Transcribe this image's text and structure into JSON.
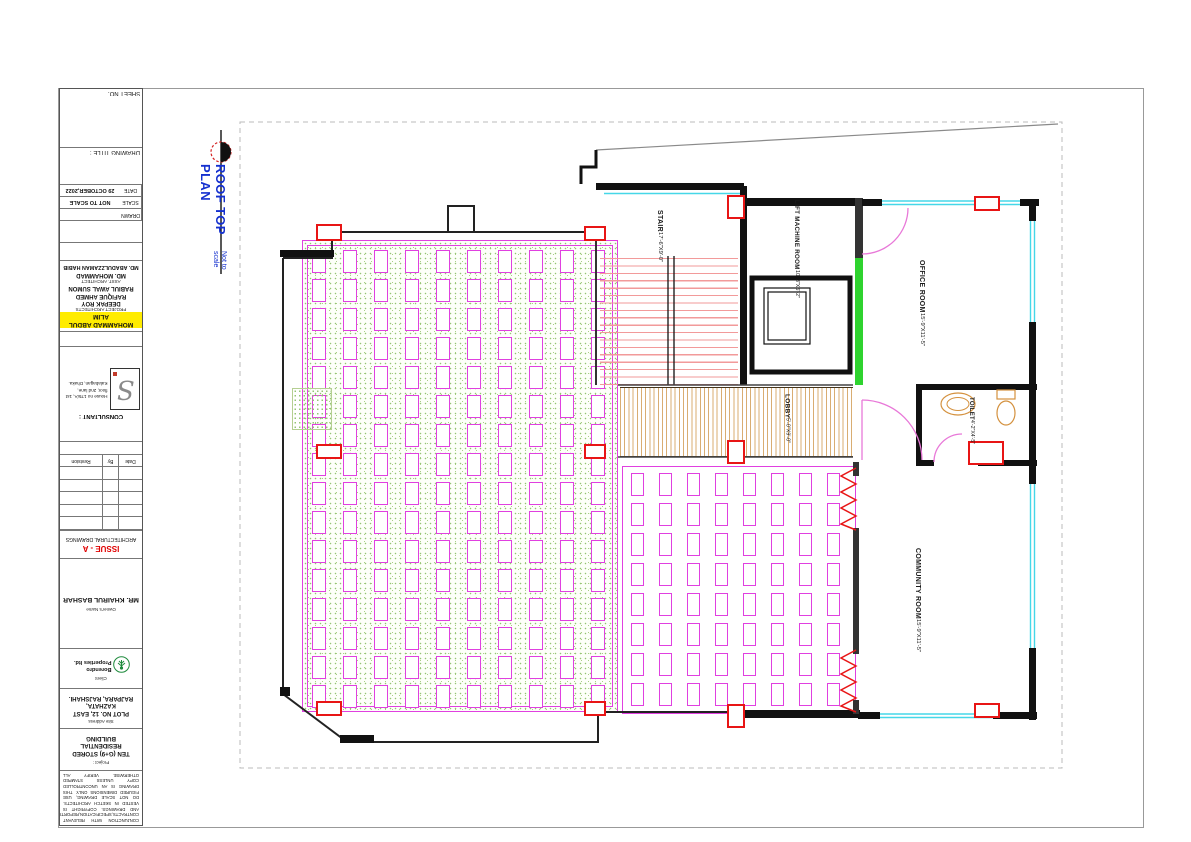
{
  "title_block": {
    "sheet_no_label": "SHEET NO.",
    "drawing_title_label": "DRAWING TITLE :",
    "fields": {
      "date_label": "DATE",
      "date_value": "29 OCTOBER,2022",
      "scale_label": "SCALE",
      "scale_value": "NOT TO SCALE",
      "drawn_label": "DRAWN",
      "drawn_value": ""
    },
    "architects": {
      "project_architect": "MOHAMMAD ABDUL ALIM",
      "project_architect_label": "PROJECT ARCHITECTS",
      "team": [
        "DEEPAK ROY",
        "RAFIQUE AHMED",
        "RABIUL AWAL SUMON"
      ],
      "asst_architect_label": "ASST. ARCHITECT",
      "assistants": [
        "MD. MOHAMMAD",
        "MD. ABADULZZAMAN HABIB"
      ]
    },
    "consultant": {
      "label": "CONSULTANT :",
      "logo_text": "S",
      "address": "House no 175/A, 1st floor, 2nd lane, Kalabagan, Dhaka."
    },
    "revision_table": {
      "columns": [
        "Date",
        "By",
        "Revision"
      ]
    },
    "issue": {
      "code": "ISSUE - A",
      "description": "ARCHITECTURAL DRAWINGS"
    },
    "owner": {
      "label": "Owner's Name",
      "name": "MR. KHAIRUL BASHAR"
    },
    "client": {
      "label": "Client",
      "name": "Borendro Properties ltd."
    },
    "site": {
      "label": "Site Address",
      "line1": "PLOT NO. 12, EAST KAZHATA,",
      "line2": "RAJPARA, RAJSHAHI."
    },
    "project": {
      "label": "Project :",
      "line1": "TEN (G+9) STORED RESIDENTIAL",
      "line2": "BUILDING"
    },
    "disclaimer": "THIS DRAWING IS TO BE READ IN CONJUNCTION WITH RELEVANT CONTRACTS,SPECIFICATION,REPORTS AND DRAWINGS. COPYRIGHT IS VESTED IN SKETCH ARCHITECTS. DO NOT SCALE DRAWING, USE FIGURED DIMENSIONS ONLY. THIS DRAWING IS AN UNCONTROLLED COPY UNLESS STAMPED OTHERWISE. VERIFY ALL DIMENSIONS ON THE SITE."
  },
  "drawing": {
    "title": "ROOF TOP PLAN",
    "subtitle": "Not to scale",
    "rooms": [
      {
        "name": "STAIR",
        "dim": "17'-6\"X9'-0\""
      },
      {
        "name": "LIFT MACHINE ROOM",
        "dim": "10'-3\"X6'-2\""
      },
      {
        "name": "OFFICE ROOM",
        "dim": "15'-9\"X11'-5\""
      },
      {
        "name": "LOBBY",
        "dim": "5'-0\"X9'-0\""
      },
      {
        "name": "TOILET",
        "dim": "4'-2\"X4'-5\""
      },
      {
        "name": "COMMUNITY ROOM",
        "dim": "15'-9\"X11'-5\""
      }
    ]
  },
  "colors": {
    "title_blue": "#1430cf",
    "issue_red": "#e00000",
    "grid_magenta": "#e040e0",
    "column_red": "#e81515",
    "window_cyan": "#45d7e8",
    "wall_green": "#2ed32e",
    "hatch_tan": "#d9ad72",
    "tread_pink": "#f29a9a",
    "highlight_yellow": "#ffec00",
    "speckle_green": "#94c473"
  }
}
